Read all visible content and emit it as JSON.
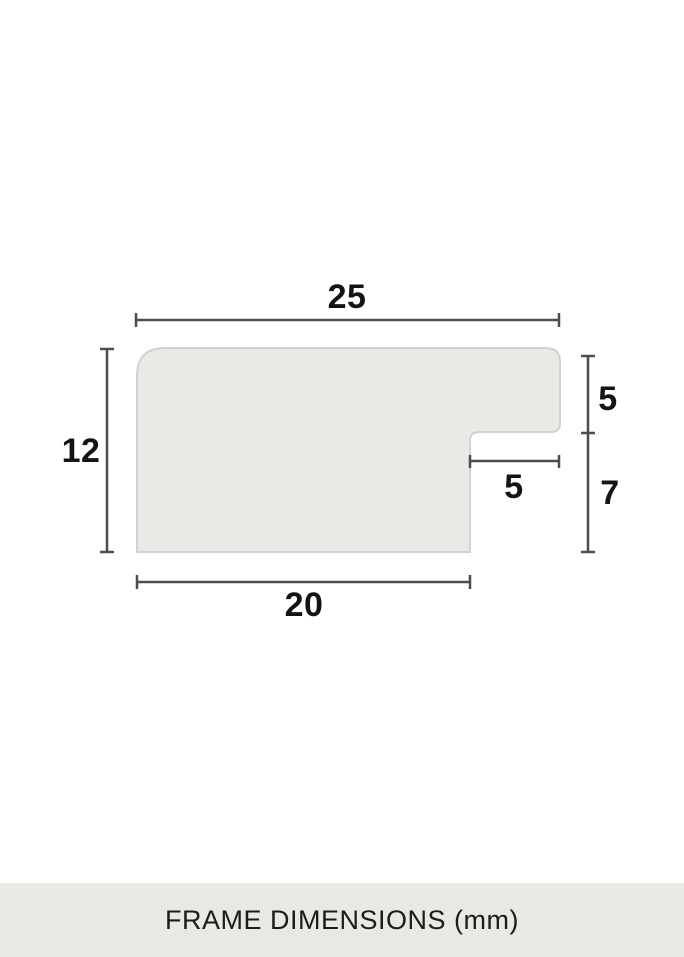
{
  "diagram": {
    "title": "Frame moulding cross-section profile",
    "caption": "FRAME DIMENSIONS (mm)",
    "unit": "mm",
    "dimensions": {
      "top_width": "25",
      "left_height": "12",
      "right_upper_height": "5",
      "notch_width": "5",
      "right_lower_height": "7",
      "bottom_width": "20"
    }
  },
  "colors": {
    "background": "#ffffff",
    "shape_fill": "#e9eae5",
    "shape_border": "#d2d3ce",
    "dimension_line": "#4d4d4d",
    "label_text": "#141414",
    "caption_band": "#e8e9e4",
    "caption_text": "#1c1c1c"
  }
}
